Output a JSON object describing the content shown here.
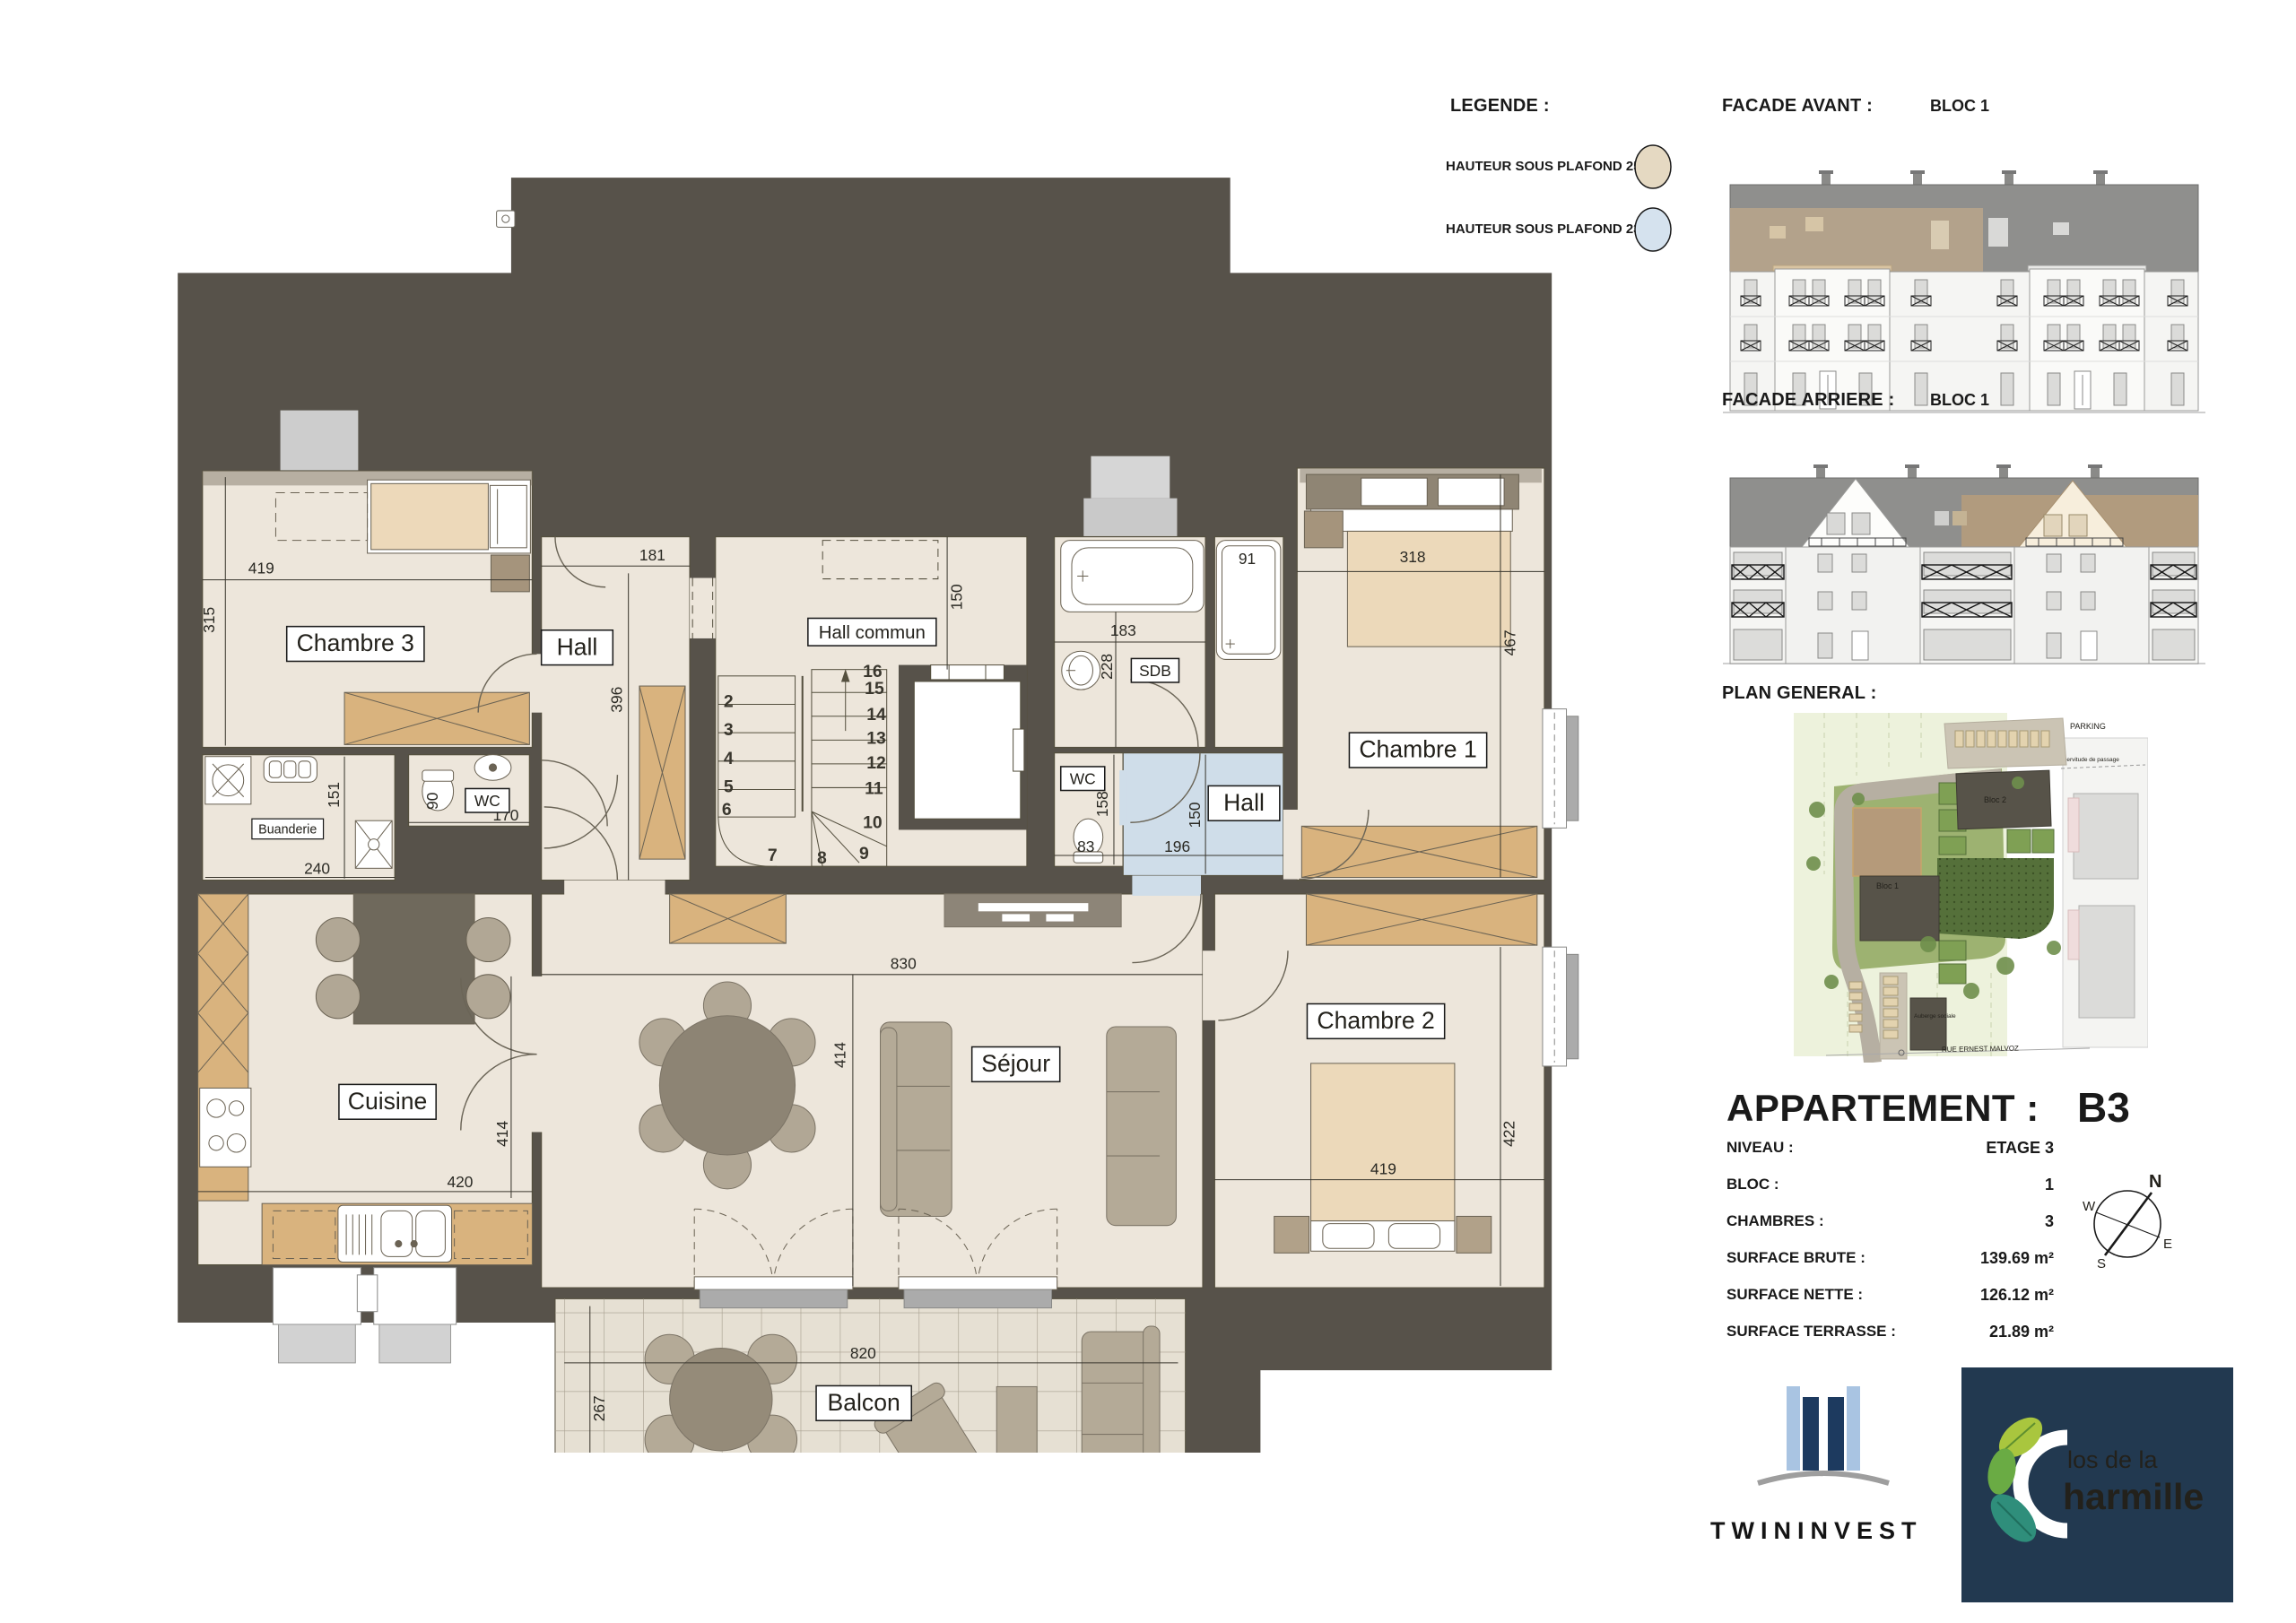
{
  "legend": {
    "title": "LEGENDE :",
    "items": [
      {
        "label": "HAUTEUR SOUS PLAFOND 250 cm",
        "color": "#E5D9C2"
      },
      {
        "label": "HAUTEUR SOUS PLAFOND 230 cm",
        "color": "#D5E2EE"
      }
    ]
  },
  "facades": {
    "avant": {
      "label": "FACADE AVANT :",
      "bloc": "BLOC 1"
    },
    "arriere": {
      "label": "FACADE ARRIERE :",
      "bloc": "BLOC 1"
    }
  },
  "plan_general": {
    "title": "PLAN GENERAL :",
    "parking": "PARKING",
    "street": "RUE ERNEST MALVOZ",
    "servitude": "Servitude de passage",
    "bloc1": "Bloc 1",
    "bloc2": "Bloc 2",
    "auberge": "Auberge sociale"
  },
  "apartment": {
    "title": "APPARTEMENT :",
    "code": "B3",
    "rows": [
      {
        "label": "NIVEAU :",
        "value": "ETAGE 3"
      },
      {
        "label": "BLOC :",
        "value": "1"
      },
      {
        "label": "CHAMBRES :",
        "value": "3"
      },
      {
        "label": "SURFACE BRUTE :",
        "value": "139.69 m²"
      },
      {
        "label": "SURFACE NETTE :",
        "value": "126.12 m²"
      },
      {
        "label": "SURFACE TERRASSE :",
        "value": "21.89 m²"
      }
    ]
  },
  "compass": {
    "n": "N",
    "e": "E",
    "s": "S",
    "w": "W"
  },
  "logos": {
    "twininvest": "TWININVEST",
    "charmille_line1": "los de la",
    "charmille_line2": "harmille"
  },
  "floorplan": {
    "rooms": {
      "chambre3": "Chambre 3",
      "hall": "Hall",
      "hall_commun": "Hall commun",
      "sdb": "SDB",
      "wc_top": "WC",
      "buanderie": "Buanderie",
      "chambre1": "Chambre 1",
      "wc_mid": "WC",
      "hall2": "Hall",
      "chambre2": "Chambre 2",
      "cuisine": "Cuisine",
      "sejour": "Séjour",
      "balcon": "Balcon"
    },
    "dims": {
      "c3w": "419",
      "c3h": "315",
      "hw": "181",
      "hh": "396",
      "hch": "150",
      "sdbw": "183",
      "sdbh": "228",
      "shower": "91",
      "c1w": "318",
      "c1h": "467",
      "wc1w": "90",
      "wc1d": "170",
      "buh": "151",
      "buw": "240",
      "wc2w": "83",
      "wc2h": "158",
      "h2h": "150",
      "h2w": "196",
      "sjw": "830",
      "sjh": "414",
      "c2w": "419",
      "c2h": "422",
      "cw": "420",
      "ch": "414",
      "bw": "820",
      "bh": "267"
    },
    "stairs": [
      "2",
      "3",
      "4",
      "5",
      "6",
      "7",
      "8",
      "9",
      "10",
      "11",
      "12",
      "13",
      "14",
      "15",
      "16"
    ]
  }
}
